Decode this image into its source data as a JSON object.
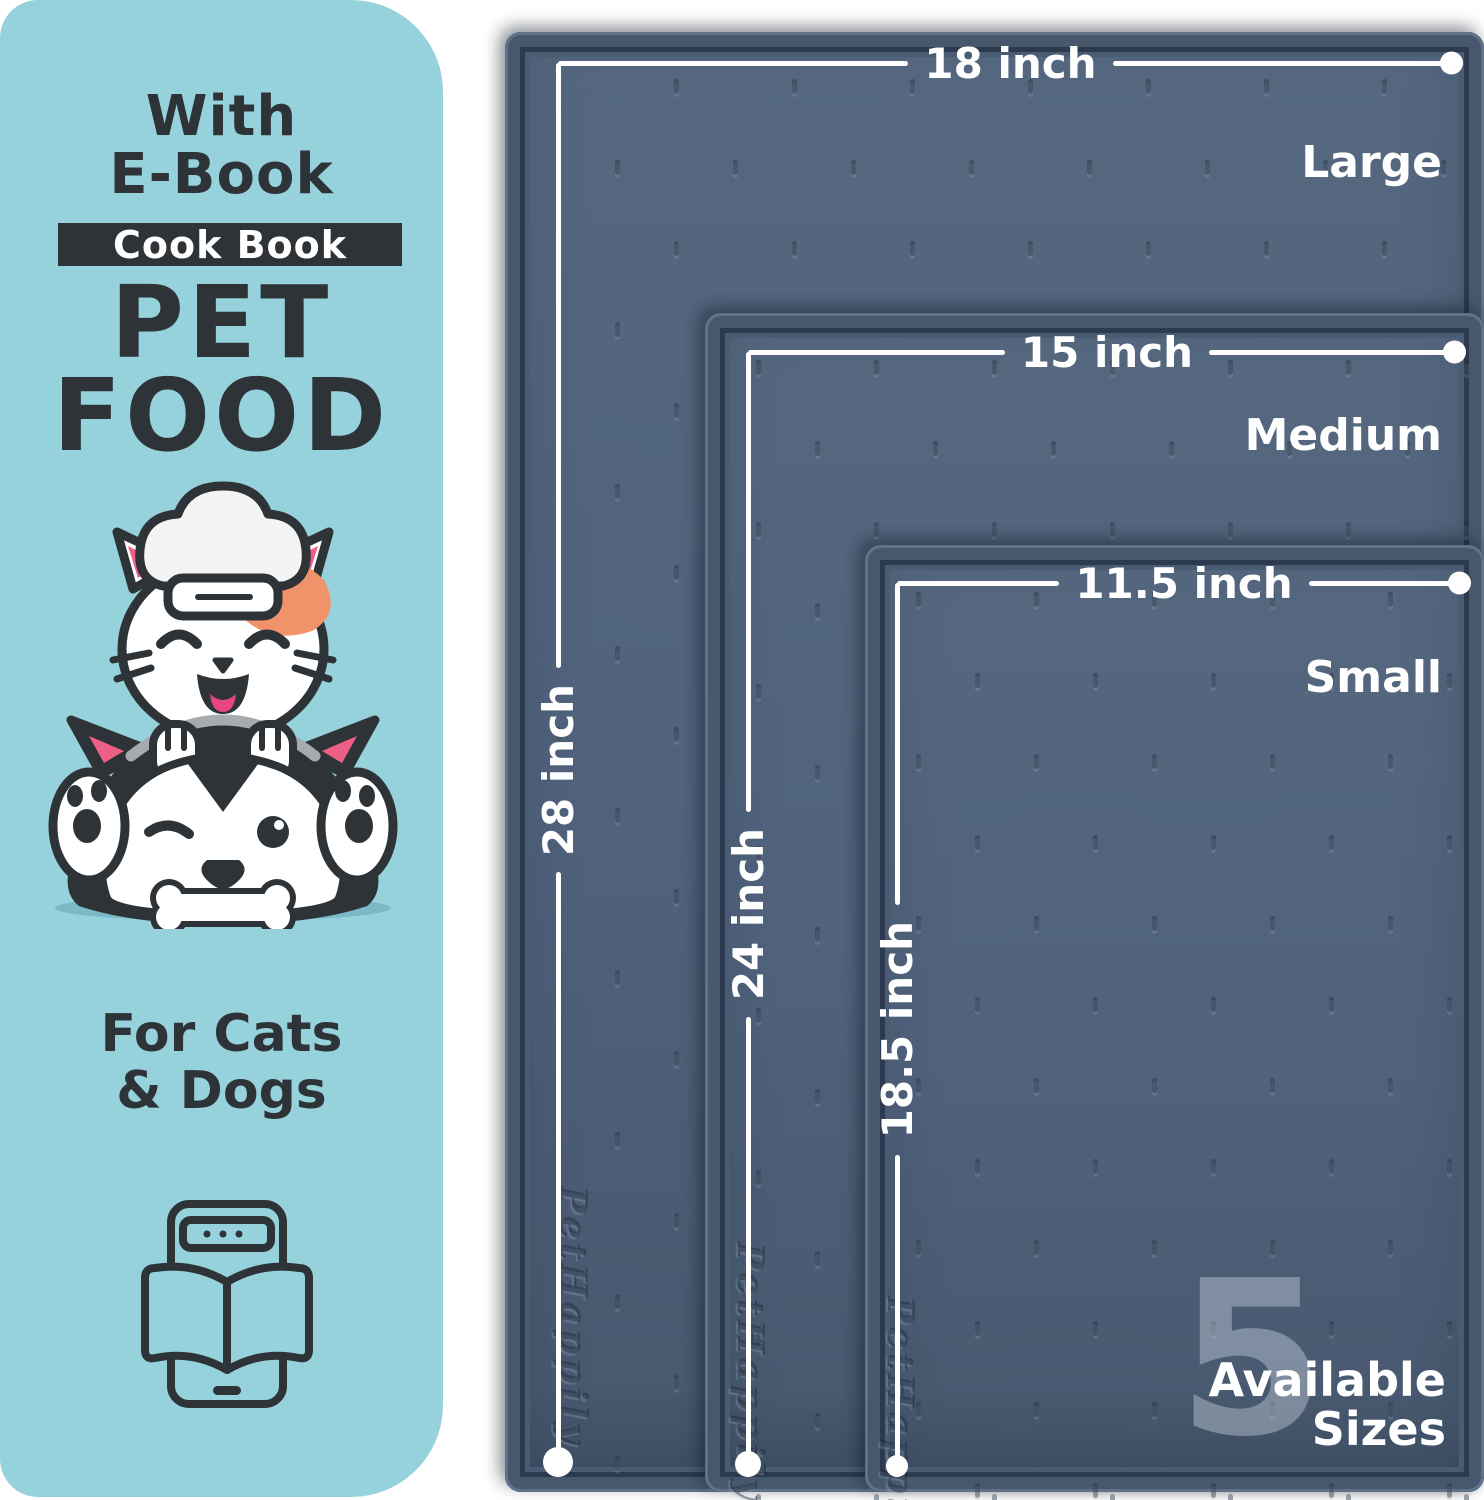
{
  "panel": {
    "with_line1": "With",
    "with_line2": "E-Book",
    "badge": "Cook Book",
    "title_line1": "PET",
    "title_line2": "FOOD",
    "subtitle_line1": "For Cats",
    "subtitle_line2": "& Dogs"
  },
  "mats": [
    {
      "size_name": "Large",
      "width_label": "18 inch",
      "height_label": "28 inch"
    },
    {
      "size_name": "Medium",
      "width_label": "15 inch",
      "height_label": "24 inch"
    },
    {
      "size_name": "Small",
      "width_label": "11.5 inch",
      "height_label": "18.5 inch"
    }
  ],
  "availability": {
    "count": "5",
    "line1": "Available",
    "line2": "Sizes"
  },
  "brand_embossed": "PetHappily",
  "colors": {
    "panel_bg": "#96d2dc",
    "ink": "#2e3338",
    "mat_surface": "#50627c",
    "mat_rim": "#47586d",
    "dimension_line": "#ffffff",
    "patch_orange": "#f0926a",
    "ear_pink": "#ee5f87",
    "tongue_pink": "#e8467e",
    "shadow_teal": "#7cb9c6"
  }
}
